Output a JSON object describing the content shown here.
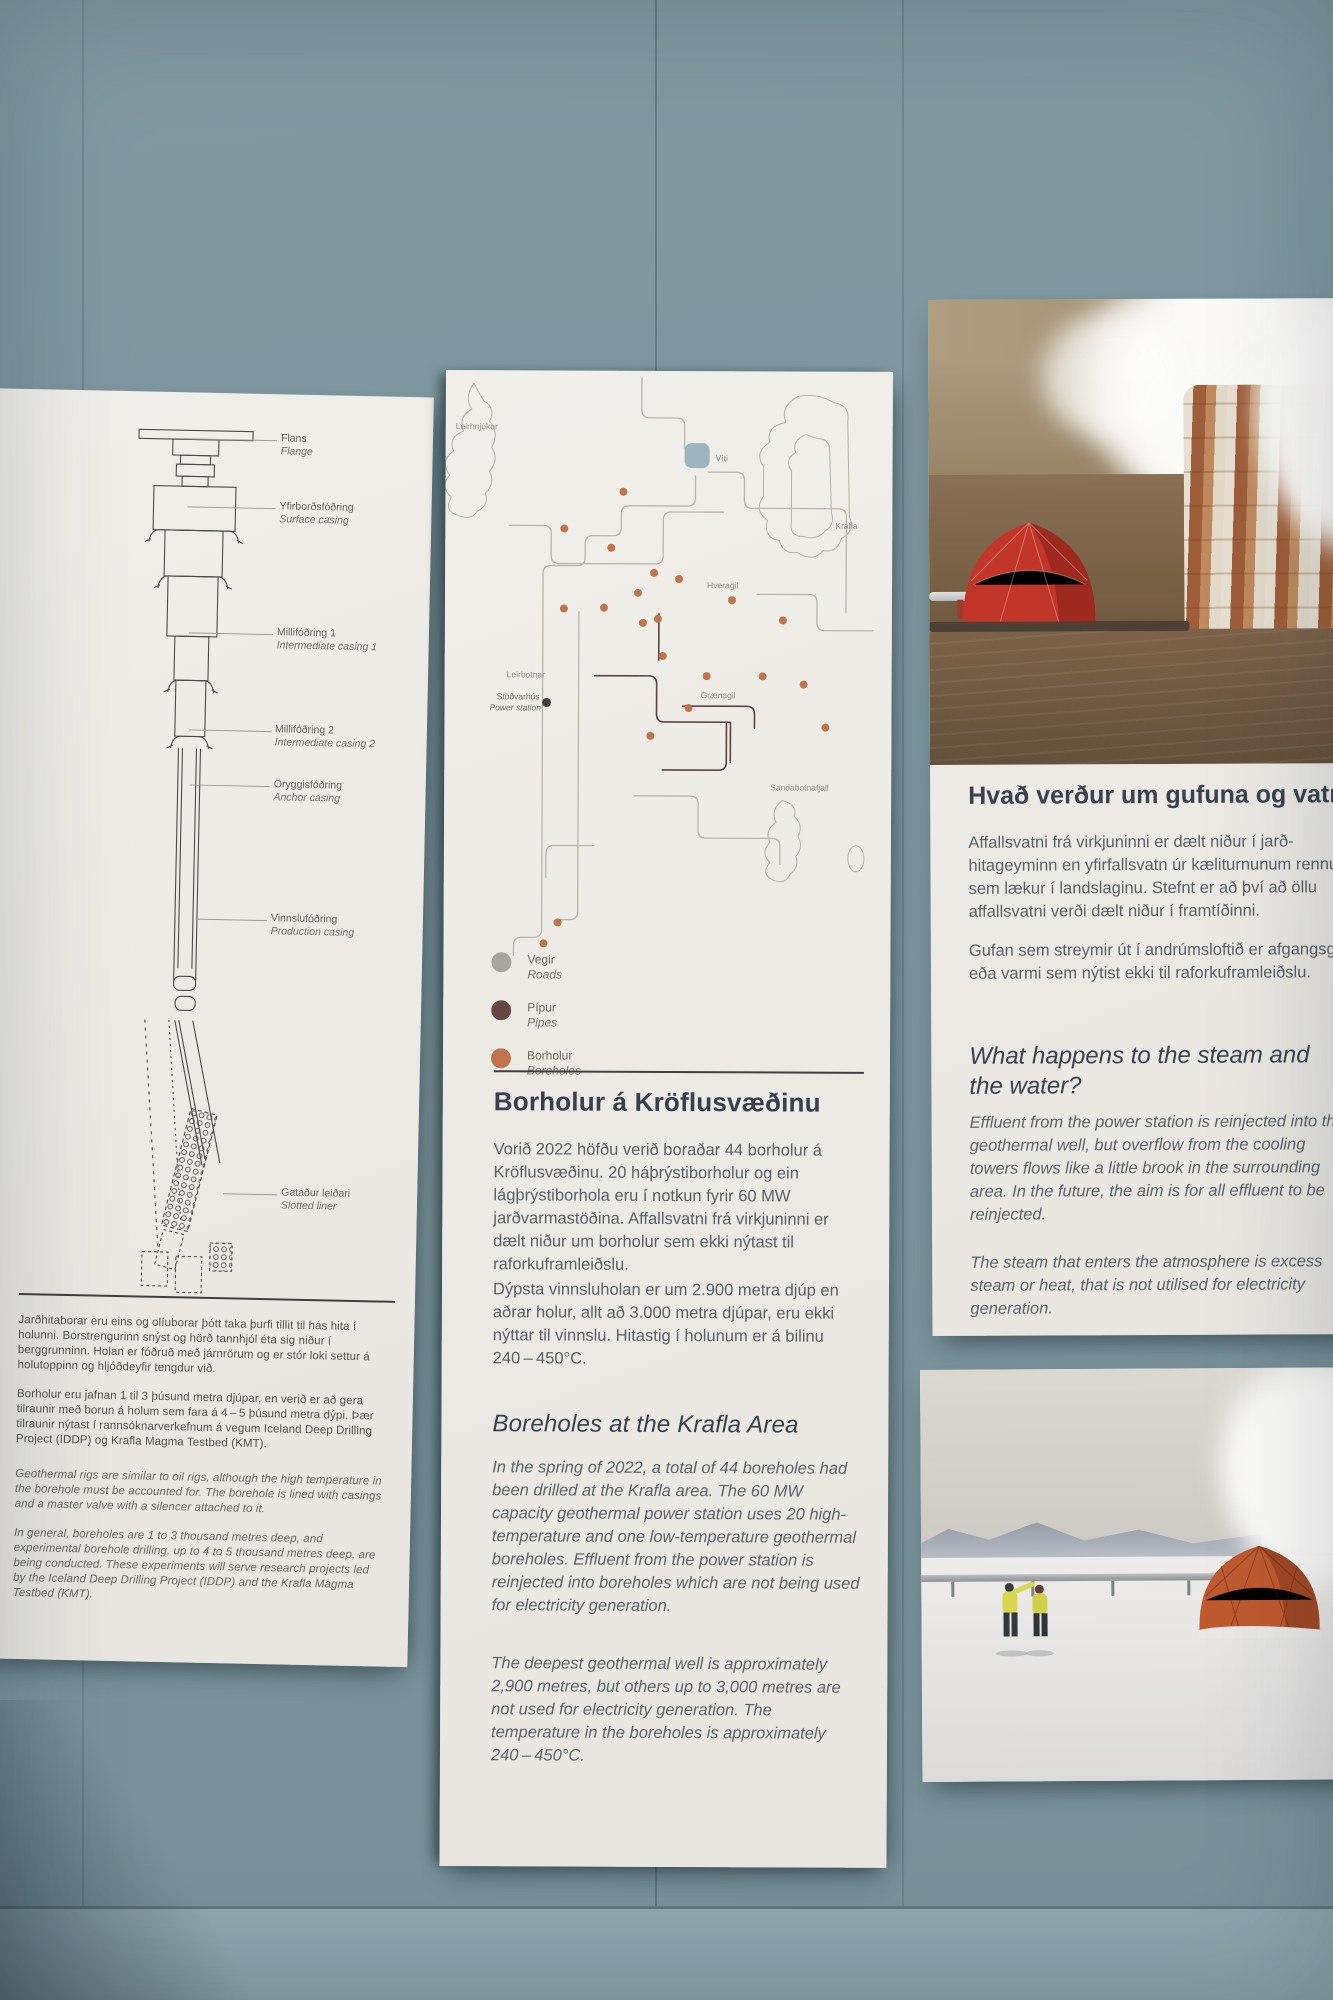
{
  "wall": {
    "color": "#7b949b",
    "bottom_band_color": "#8ea6ac"
  },
  "left_panel": {
    "diagram_labels": [
      {
        "is": "Flans",
        "en": "Flange"
      },
      {
        "is": "Yfirborðsfóðring",
        "en": "Surface casing"
      },
      {
        "is": "Millifóðring 1",
        "en": "Intermediate casing 1"
      },
      {
        "is": "Millifóðring 2",
        "en": "Intermediate casing 2"
      },
      {
        "is": "Öryggisfóðring",
        "en": "Anchor casing"
      },
      {
        "is": "Vinnslufóðring",
        "en": "Production casing"
      },
      {
        "is": "Gataður leiðari",
        "en": "Slotted liner"
      }
    ],
    "body_is": [
      "Jarðhitaborar eru eins og olíuborar þótt taka þurfi tillit til hás hita í holunni. Borstrengurinn snýst og hörð tannhjól éta sig niður í berggrunninn. Holan er fóðruð með járnrörum og er stór loki settur á holutoppinn og hljóðdeyfir tengdur við.",
      "Borholur eru jafnan 1 til 3 þúsund metra djúpar, en verið er að gera tilraunir með borun á holum sem fara á 4 – 5 þúsund metra dýpi. Þær tilraunir nýtast í rannsóknarverkefnum á vegum Iceland Deep Drilling Project (IDDP) og Krafla Magma Testbed (KMT)."
    ],
    "body_en": [
      "Geothermal rigs are similar to oil rigs, although the high temperature in the borehole must be accounted for. The borehole is lined with casings and a master valve with a silencer attached to it.",
      "In general, boreholes are 1 to 3 thousand metres deep, and experimental borehole drilling, up to 4 to 5 thousand metres deep, are being conducted. These experiments will serve research projects led by the Iceland Deep Drilling Project (IDDP) and the Krafla Magma Testbed (KMT)."
    ]
  },
  "middle_panel": {
    "map_labels": {
      "leirhnjukur": "Leirhnjúkur",
      "viti": "Víti",
      "krafla": "Krafla",
      "hveragil": "Hveragil",
      "leirbotnar": "Leirbotnar",
      "stodvarhus_is": "Stöðvarhús",
      "power_station_en": "Power station",
      "graenagil": "Grænagil",
      "sandabotnafjall": "Sandabotnafjall"
    },
    "legend": [
      {
        "is": "Vegir",
        "en": "Roads",
        "color": "#a8a4a0"
      },
      {
        "is": "Pípur",
        "en": "Pipes",
        "color": "#664741"
      },
      {
        "is": "Borholur",
        "en": "Boreholes",
        "color": "#c0744c"
      }
    ],
    "title_is": "Borholur á Kröflusvæðinu",
    "body_is": [
      "Vorið 2022 höfðu verið boraðar 44 borholur á Kröflusvæðinu.  20 háþrýstiborholur og ein lágþrýstiborhola eru í notkun fyrir 60 MW jarðvarmastöðina. Affallsvatni frá virkjuninni er dælt niður um borholur sem ekki nýtast til raforkuframleiðslu.",
      "Dýpsta vinnsluholan er um 2.900 metra djúp en aðrar holur, allt að 3.000 metra djúpar, eru ekki nýttar til vinnslu. Hitastig í holunum er á bilinu 240 – 450°C."
    ],
    "title_en": "Boreholes at the Krafla Area",
    "body_en": [
      "In the spring of 2022, a total of 44 boreholes had been drilled at the Krafla area. The 60 MW capacity geothermal power station uses 20 high-temperature and one low-temperature geothermal boreholes. Effluent from the power station is reinjected into boreholes which are not being used for electricity generation.",
      "The deepest geothermal well is approximately 2,900 metres, but others up to 3,000 metres are not used for electricity generation. The temperature in the boreholes is approximately 240 – 450°C."
    ]
  },
  "right_top_panel": {
    "title_is": "Hvað verður um gufuna og vatnið?",
    "body_is": [
      "Affallsvatni frá virkjuninni er dælt niður í jarð­hitageyminn en yfirfallsvatn úr kæliturnunum rennur sem lækur í landslaginu. Stefnt er að því að öllu affallsvatni verði dælt niður í framtíðinni.",
      "Gufan sem streymir út í andrúmsloftið er afgangsgufa eða varmi sem nýtist ekki til raforkuframleiðslu."
    ],
    "title_en": "What happens to the steam and the water?",
    "body_en": [
      "Effluent from the power station is reinjected into the geothermal well, but overflow from the cooling towers flows like a little brook in the surrounding area. In the future, the aim is for all effluent to be reinjected.",
      "The steam that enters the atmosphere is excess steam or heat, that is not utilised for electricity generation."
    ]
  }
}
